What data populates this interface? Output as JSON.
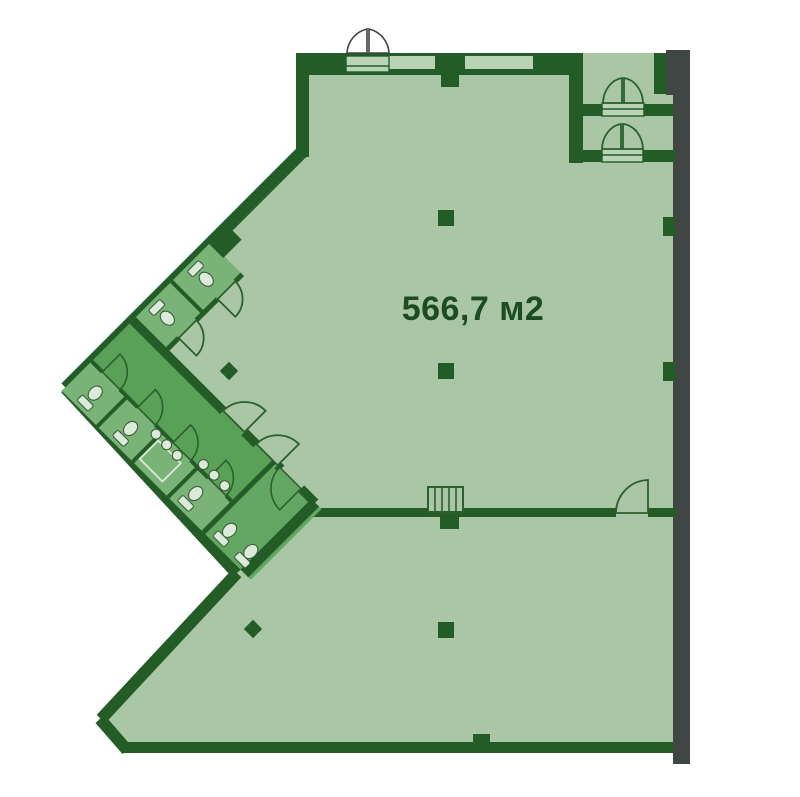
{
  "page": {
    "background": "#ffffff"
  },
  "floorplan": {
    "area_label": "566,7 м2",
    "colors": {
      "floor": "#a9c7a4",
      "wall_green": "#245c28",
      "wall_gray": "#3f4643",
      "room_medium": "#58a156",
      "room_light": "#79b377",
      "room_end": "#63a862",
      "window": "#b9d4b4",
      "fixture_fill": "#dceada",
      "fixture_stroke": "#3a5f3a",
      "door_stroke": "#2c5f2e",
      "label_color": "#1d4c22"
    }
  }
}
